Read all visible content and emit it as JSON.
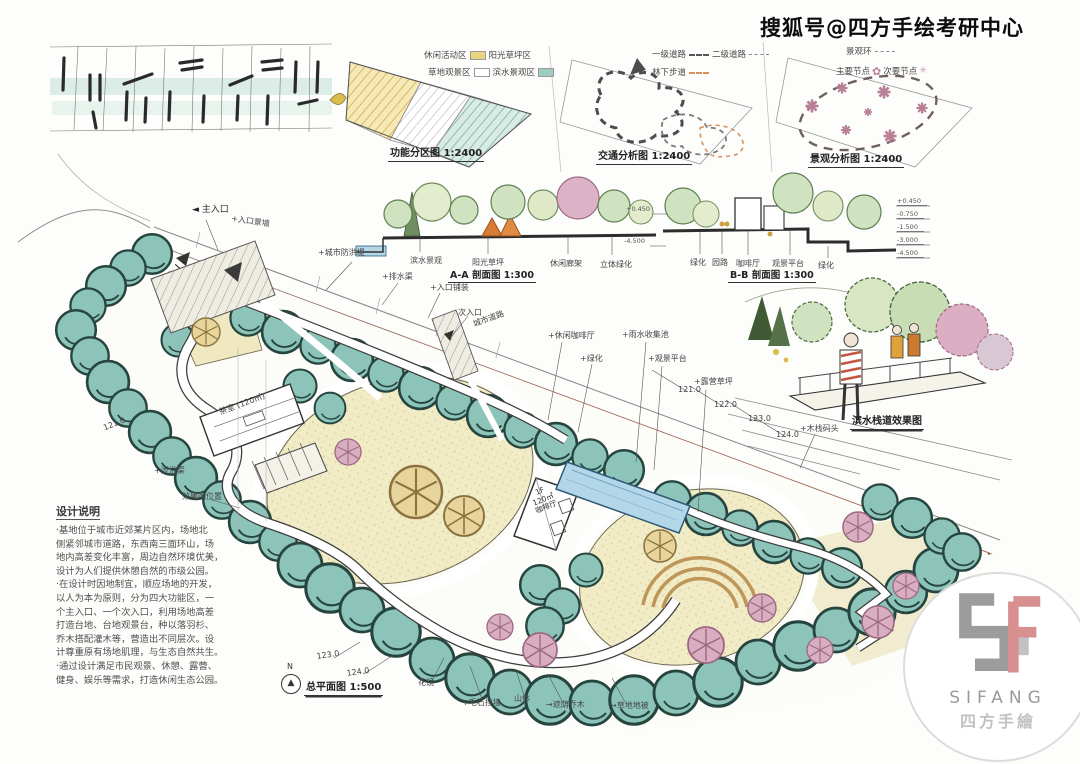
{
  "watermark": "搜狐号@四方手绘考研中心",
  "colors": {
    "tree_teal": "#8cc4ba",
    "lawn_cream": "#f1ecc6",
    "tree_pink": "#d9aec1",
    "water_blue": "#b3d6e9",
    "boundary_red": "#a85540",
    "zone_yellow": "#e9d37e",
    "zone_teal": "#9fccc2",
    "logo_gray": "#9c9c9c",
    "logo_pink": "#d88f8f"
  },
  "diagrams": {
    "zoning": {
      "caption": "功能分区图 1:2400",
      "legend": [
        {
          "label": "休闲活动区",
          "color": "#e9d37e"
        },
        {
          "label": "阳光草坪区",
          "color": "#f1ecc6"
        },
        {
          "label": "草地观景区",
          "color": "#ffffff"
        },
        {
          "label": "滨水景观区",
          "color": "#9fccc2"
        }
      ]
    },
    "traffic": {
      "caption": "交通分析图 1:2400",
      "legend": [
        {
          "label": "一级道路"
        },
        {
          "label": "二级道路"
        },
        {
          "label": "林下步道"
        }
      ]
    },
    "scenic": {
      "caption": "景观分析图 1:2400",
      "legend": [
        {
          "label": "景观环"
        },
        {
          "label": "主要节点"
        },
        {
          "label": "次要节点"
        }
      ]
    }
  },
  "sections": {
    "aa": {
      "caption": "A-A 剖面图 1:300",
      "labels": [
        "滨水景观",
        "阳光草坪",
        "休闲廊架",
        "立体绿化"
      ]
    },
    "bb": {
      "caption": "B-B 剖面图 1:300",
      "labels": [
        "绿化",
        "园路",
        "咖啡厅",
        "观景平台",
        "绿化"
      ],
      "elev_left": [
        "+0.450",
        "-4.500"
      ],
      "elev_stack": [
        "+0.450",
        "-0.750",
        "-1.500",
        "-3.000",
        "-4.500"
      ]
    }
  },
  "perspective": {
    "caption": "滨水栈道效果图"
  },
  "plan": {
    "caption": "总平面图 1:500",
    "north": "N",
    "cafe": {
      "l1": "1F",
      "l2": "120㎡",
      "l3": "咖啡厅"
    },
    "labels": {
      "main_entrance": "主入口",
      "entrance_wall": "+入口景墙",
      "flood_dike": "+城市防洪堤",
      "drain_channel": "+排水渠",
      "entrance_paving": "+入口铺装",
      "secondary_entrance": "次入口",
      "city_road": "城市道路",
      "leisure_cafe": "+休闲咖啡厅",
      "greenery": "+绿化",
      "rainwater_pond": "+雨水收集池",
      "viewing_platform": "+观景平台",
      "camping_lawn": "+露营草坪",
      "boardwalk_pier": "+木栈码头",
      "tea_house": "茶室 (120㎡)",
      "perspective_marker": "效果图位置",
      "spillway": "+泄洪渠",
      "flower_border": "花镜",
      "stone_wall": "+毛石挡墙",
      "mountain": "山体",
      "shade_trees": "→遮荫乔木",
      "groundcover": "→草地地被"
    },
    "contours": {
      "c121": "121.0",
      "c122": "122.0",
      "c123": "123.0",
      "c124": "124.0",
      "c121_left": "121.0",
      "c123_b": "123.0",
      "c124_b": "124.0"
    }
  },
  "notes": {
    "title": "设计说明",
    "lines": [
      "·基地位于城市近郊某片区内，场地北",
      "侧紧邻城市道路，东西南三面环山，场",
      "地内高差变化丰富，周边自然环境优美，",
      "设计为人们提供休憩自然的市级公园。",
      "·在设计时因地制宜，顺应场地的开发，",
      "以人为本为原则，分为四大功能区，一",
      "个主入口、一个次入口，利用场地高差",
      "打造台地、台地观景台，种以落羽杉、",
      "乔木搭配灌木等，营造出不同层次。设",
      "计尊重原有场地肌理，与生态自然共生。",
      "·通过设计满足市民观景、休憩、露营、",
      "健身、娱乐等需求，打造休闲生态公园。"
    ]
  },
  "icons": {
    "main_node": "✿",
    "secondary_node": "✳",
    "north_arrow": "▲",
    "entrance_arrow": "◄"
  },
  "logo": {
    "name": "SIFANG",
    "cn": "四方手繪"
  }
}
